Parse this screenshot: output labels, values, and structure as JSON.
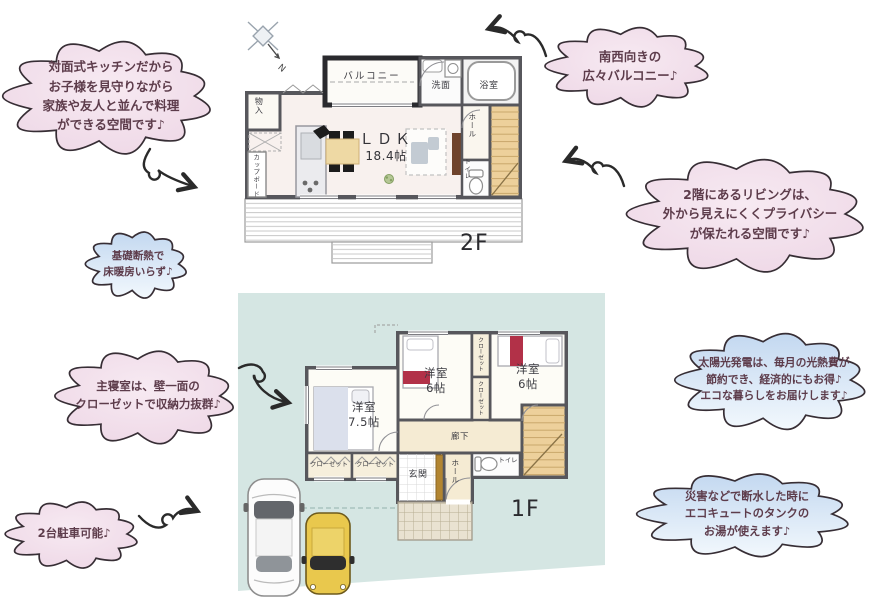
{
  "clouds": {
    "kitchen": {
      "text": "対面式キッチンだから\nお子様を見守りながら\n家族や友人と並んで料理\nができる空間です♪"
    },
    "balcony": {
      "text": "南西向きの\n広々バルコニー♪"
    },
    "living": {
      "text": "2階にあるリビングは、\n外から見えにくくプライバシー\nが保たれる空間です♪"
    },
    "insulation": {
      "text": "基礎断熱で\n床暖房いらず♪"
    },
    "bedroom": {
      "text": "主寝室は、壁一面の\nクローゼットで収納力抜群♪"
    },
    "solar": {
      "text": "太陽光発電は、毎月の光熱費が\n節約でき、経済的にもお得♪\nエコな暮らしをお届けします♪"
    },
    "parking": {
      "text": "2台駐車可能♪"
    },
    "disaster": {
      "text": "災害などで断水した時に\nエコキュートのタンクの\nお湯が使えます♪"
    }
  },
  "floor2": {
    "floor_label": "2F",
    "balcony": "バルコニー",
    "washroom": "洗面",
    "bathroom": "浴室",
    "ldk_name": "ＬＤＫ",
    "ldk_size": "18.4帖",
    "storage": "物入",
    "cupboard": "カップボード",
    "hall": "ホール",
    "toilet": "トイレ"
  },
  "floor1": {
    "floor_label": "1F",
    "bedroom_master": "洋室\n7.5帖",
    "bedroom2": "洋室\n6帖",
    "bedroom3": "洋室\n6帖",
    "closet_upper1": "クローゼット",
    "closet_upper2": "クローゼット",
    "closet_lower1": "クローゼット",
    "closet_lower2": "クローゼット",
    "corridor": "廊下",
    "entrance": "玄関",
    "hall": "ホール",
    "toilet": "トイレ"
  },
  "compass_label": "N",
  "colors": {
    "cloud_text": "#5d3c4b",
    "cloud_pink": "#eed7e6",
    "cloud_blue": "#c3d8f0",
    "site": "#d5e6e3",
    "wall": "#57575c",
    "stairs": "#edd09b",
    "accent_red": "#b23148",
    "car_yellow": "#e9c84d",
    "ldk_floor": "#f8f1ee",
    "cream_floor": "#f5ebd3"
  }
}
